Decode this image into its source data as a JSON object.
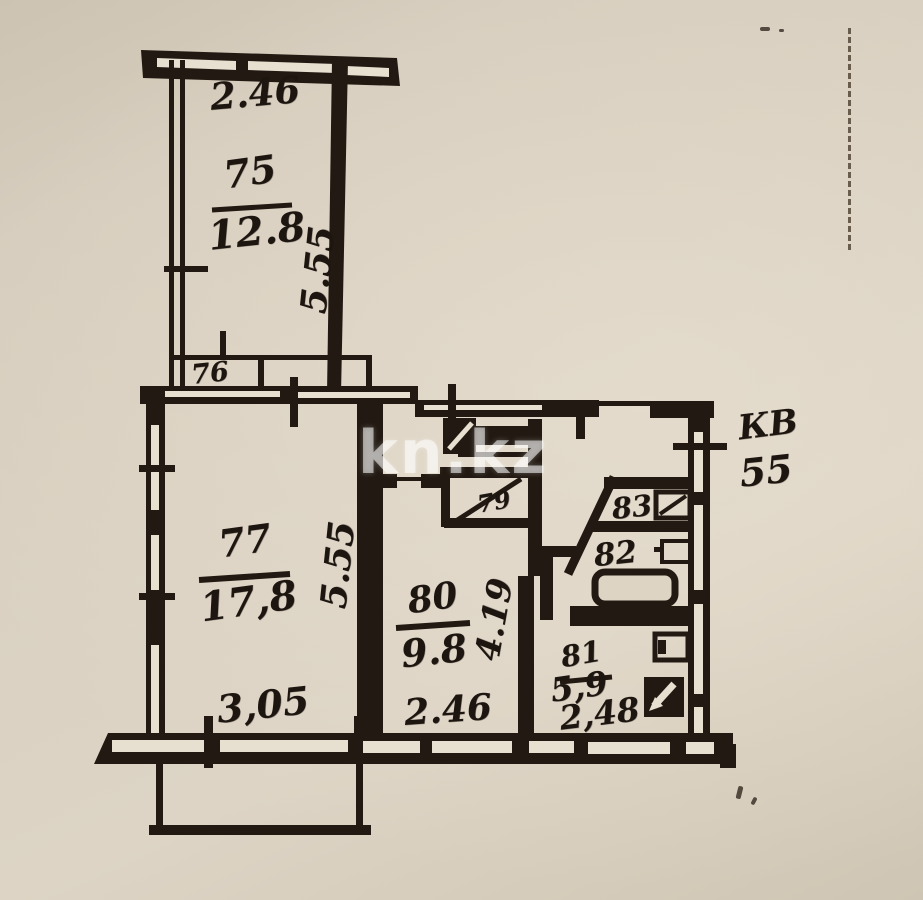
{
  "plan": {
    "watermark": "kn.kz",
    "apartment": {
      "prefix": "КВ",
      "number": "55"
    },
    "rooms": {
      "r75": {
        "number": "75",
        "area": "12.8"
      },
      "r76": {
        "number": "76"
      },
      "r77": {
        "number": "77",
        "area": "17,8"
      },
      "r79": {
        "number": "79"
      },
      "r80": {
        "number": "80",
        "area": "9.8"
      },
      "r81": {
        "number": "81",
        "area": "5,9"
      },
      "r82": {
        "number": "82"
      },
      "r83": {
        "number": "83"
      }
    },
    "dimensions": {
      "r75_width": "2.46",
      "r75_depth": "5.55",
      "r77_width": "3,05",
      "r77_depth": "5.55",
      "r80_width": "2.46",
      "r80_depth": "4.19",
      "r81_width": "2,48"
    },
    "colors": {
      "paper": "#d9d0c1",
      "ink": "#221a12",
      "watermark": "rgba(255,255,255,0.55)"
    }
  }
}
